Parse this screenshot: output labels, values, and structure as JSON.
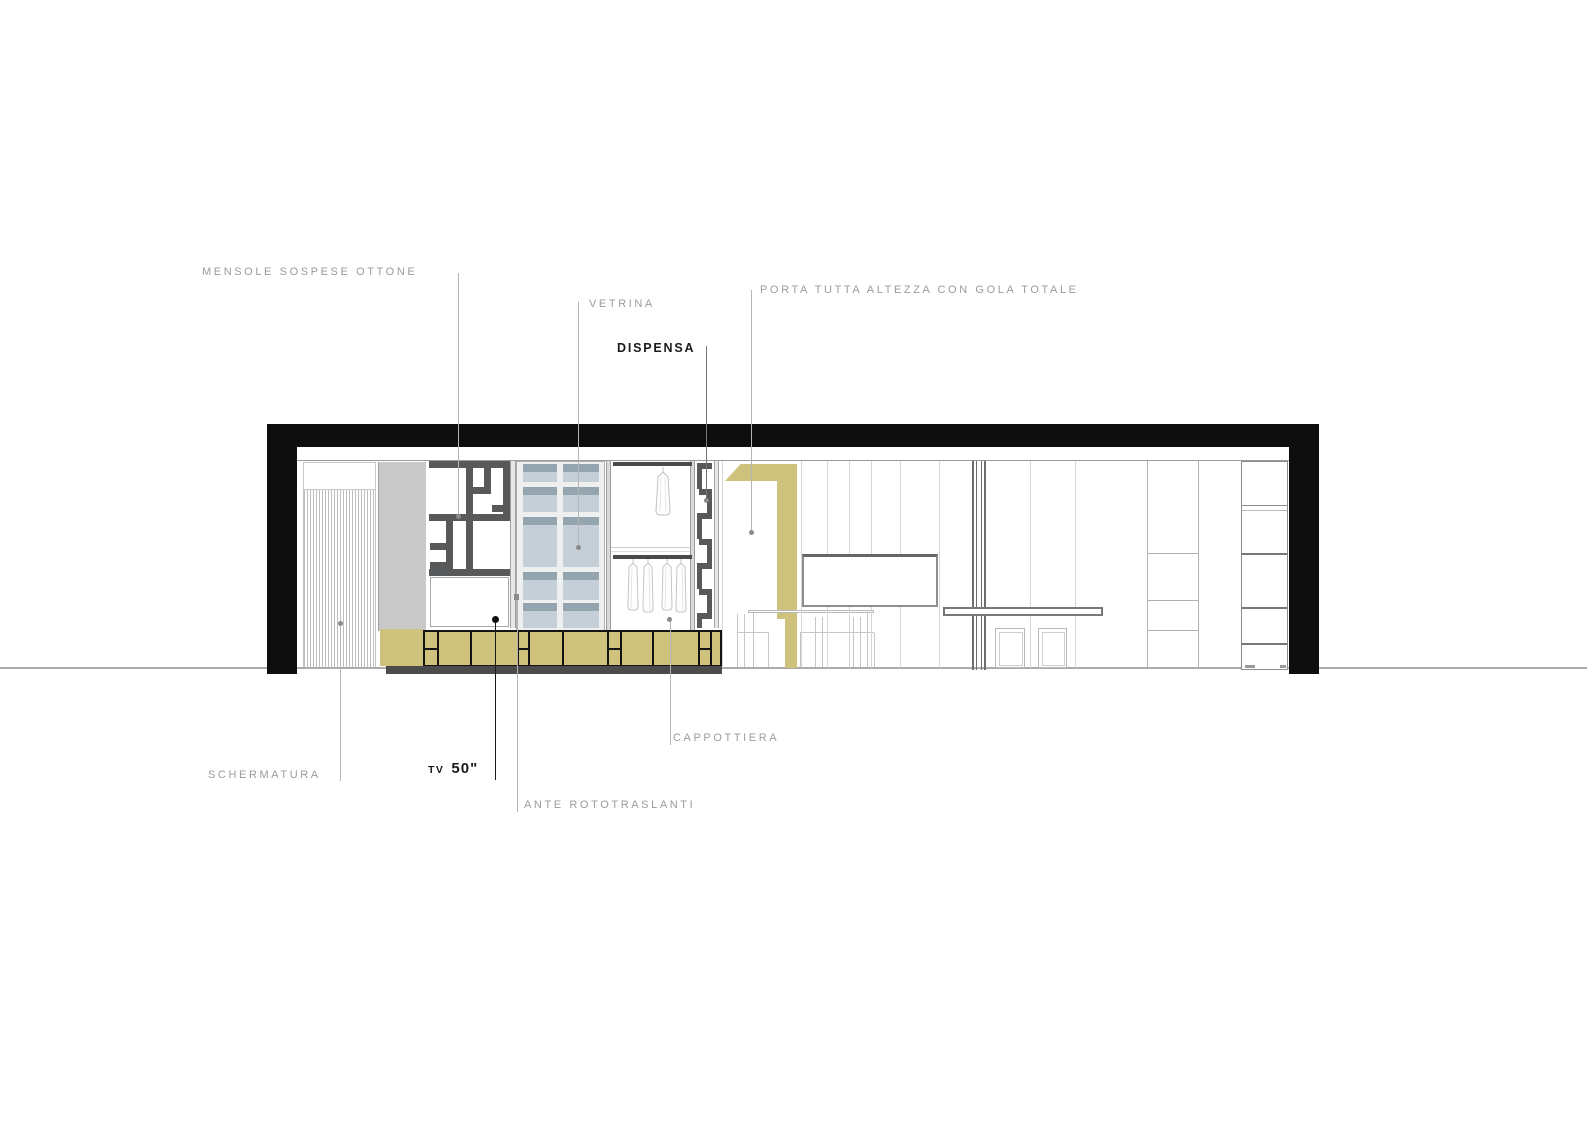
{
  "annotations": {
    "mensole": {
      "text": "MENSOLE SOSPESE OTTONE"
    },
    "vetrina": {
      "text": "VETRINA"
    },
    "dispensa": {
      "text": "DISPENSA"
    },
    "porta": {
      "text": "PORTA TUTTA ALTEZZA CON GOLA TOTALE"
    },
    "schermatura": {
      "text": "SCHERMATURA"
    },
    "tv": {
      "prefix": "TV",
      "size": "50\""
    },
    "ante": {
      "text": "ANTE ROTOTRASLANTI"
    },
    "cappottiera": {
      "text": "CAPPOTTIERA"
    }
  },
  "colors": {
    "frame_black": "#0e0e0e",
    "gold_accent": "#cfc27c",
    "glass_light": "#c4cfd8",
    "glass_shadow": "#95a5b0",
    "shelf_dark": "#58595b",
    "plinth_dark": "#4b4b4b",
    "label_gray": "#9b9b9b",
    "label_black": "#1a1a1a",
    "leader_gray": "#b5b5b5"
  }
}
